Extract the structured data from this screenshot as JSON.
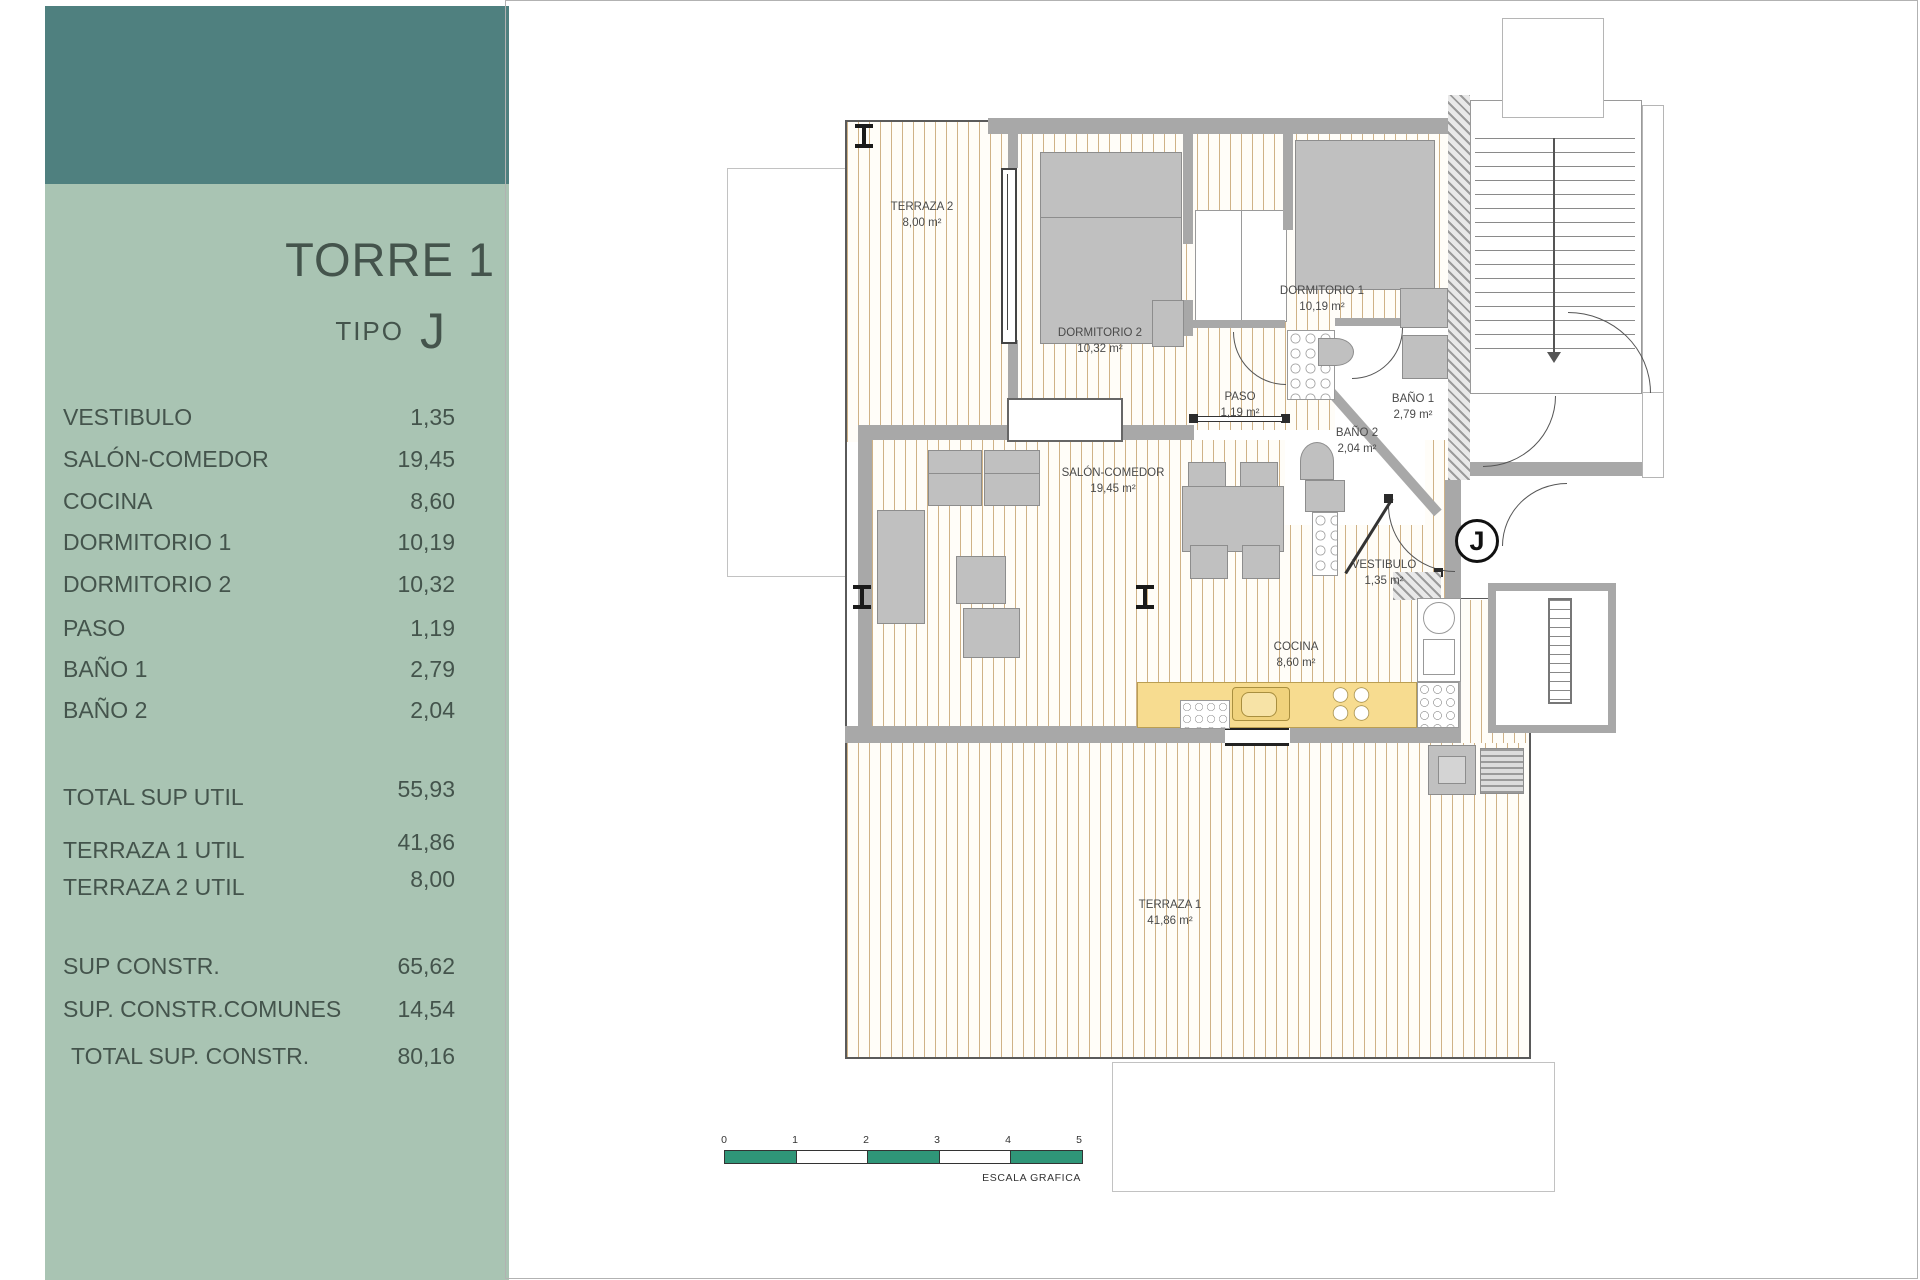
{
  "sidebar": {
    "title": "TORRE 1",
    "tipo_label": "TIPO",
    "tipo_value": "J",
    "rows": [
      {
        "label": "VESTIBULO",
        "value": "1,35"
      },
      {
        "label": "SALÓN-COMEDOR",
        "value": "19,45"
      },
      {
        "label": "COCINA",
        "value": "8,60"
      },
      {
        "label": "DORMITORIO 1",
        "value": "10,19"
      },
      {
        "label": "DORMITORIO 2",
        "value": "10,32"
      },
      {
        "label": "PASO",
        "value": "1,19"
      },
      {
        "label": "BAÑO 1",
        "value": "2,79"
      },
      {
        "label": "BAÑO 2",
        "value": "2,04"
      }
    ],
    "total_util": {
      "label": "TOTAL SUP UTIL",
      "value": "55,93"
    },
    "terrazas": [
      {
        "label": "TERRAZA 1 UTIL",
        "value": "41,86"
      },
      {
        "label": "TERRAZA 2 UTIL",
        "value": "8,00"
      }
    ],
    "constr": [
      {
        "label": "SUP CONSTR.",
        "value": "65,62"
      },
      {
        "label": "SUP. CONSTR.COMUNES",
        "value": "14,54"
      },
      {
        "label": "TOTAL SUP. CONSTR.",
        "value": "80,16"
      }
    ]
  },
  "plan": {
    "rooms": [
      {
        "name": "TERRAZA 2",
        "area": "8,00 m²"
      },
      {
        "name": "DORMITORIO 2",
        "area": "10,32 m²"
      },
      {
        "name": "DORMITORIO 1",
        "area": "10,19 m²"
      },
      {
        "name": "PASO",
        "area": "1,19 m²"
      },
      {
        "name": "BAÑO 1",
        "area": "2,79 m²"
      },
      {
        "name": "BAÑO 2",
        "area": "2,04 m²"
      },
      {
        "name": "SALÓN-COMEDOR",
        "area": "19,45 m²"
      },
      {
        "name": "VESTIBULO",
        "area": "1,35 m²"
      },
      {
        "name": "COCINA",
        "area": "8,60 m²"
      },
      {
        "name": "TERRAZA 1",
        "area": "41,86 m²"
      }
    ],
    "unit_badge": "J"
  },
  "scalebar": {
    "ticks": [
      "0",
      "1",
      "2",
      "3",
      "4",
      "5"
    ],
    "label": "ESCALA GRAFICA"
  },
  "colors": {
    "header_teal": "#4F807F",
    "panel_green": "#A9C4B3",
    "text_green": "#44544C",
    "kitchen_yellow": "#F7DC90",
    "scale_green": "#2F9678",
    "wall_gray": "#A8A8A8"
  }
}
